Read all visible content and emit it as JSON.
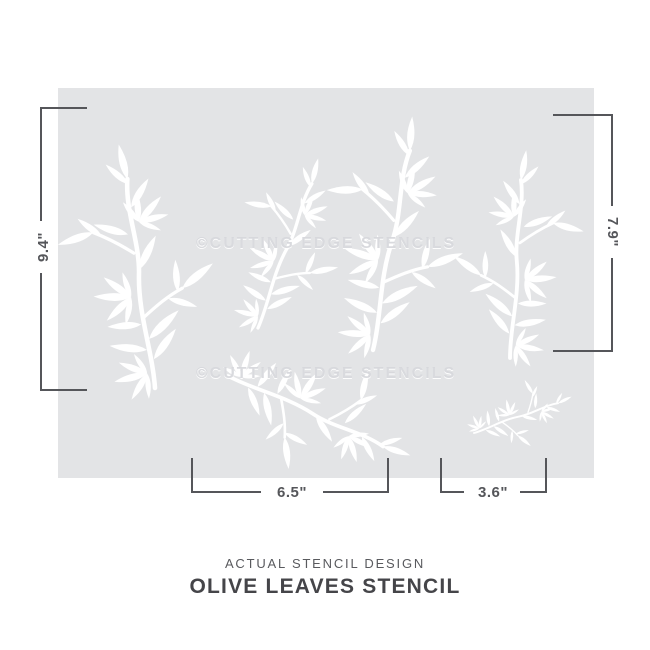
{
  "product": {
    "name": "Olive Leaves Stencil",
    "sheet_color": "#e3e4e6",
    "design_color": "#ffffff",
    "watermark": "©CUTTING EDGE STENCILS"
  },
  "dimensions": {
    "left_height": "9.4\"",
    "right_height": "7.9\"",
    "bottom_left_width": "6.5\"",
    "bottom_right_width": "3.6\"",
    "line_color": "#55565a"
  },
  "caption": {
    "subtitle": "ACTUAL STENCIL DESIGN",
    "title": "OLIVE LEAVES STENCIL",
    "subtitle_color": "#595a5e",
    "title_color": "#454549"
  }
}
